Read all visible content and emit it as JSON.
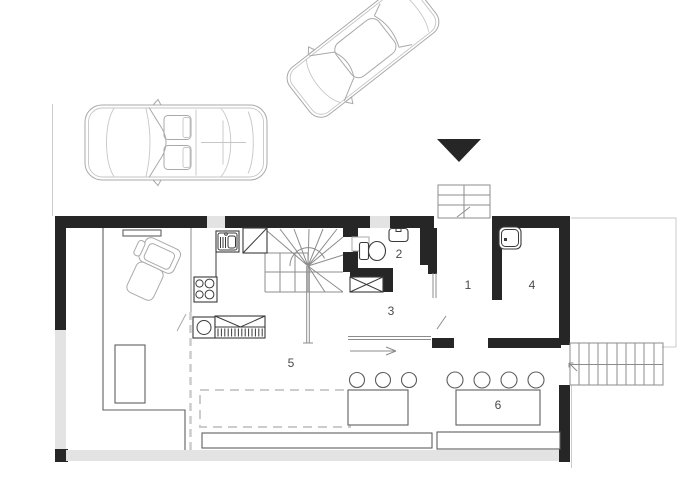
{
  "plan": {
    "type": "architectural-floor-plan-ground-floor",
    "rooms": [
      {
        "number": "1"
      },
      {
        "number": "2"
      },
      {
        "number": "3"
      },
      {
        "number": "4"
      },
      {
        "number": "5"
      },
      {
        "number": "6"
      }
    ],
    "colors": {
      "wall": "#262626",
      "window": "#e3e3e3",
      "label": "#4a4a4a",
      "fixture": "#3a3a3a",
      "stair": "#8c8c8c",
      "light": "#a9a9a9",
      "lighter": "#c6c6c6",
      "mid": "#5f5f5f",
      "dashed": "#cccccc"
    }
  }
}
